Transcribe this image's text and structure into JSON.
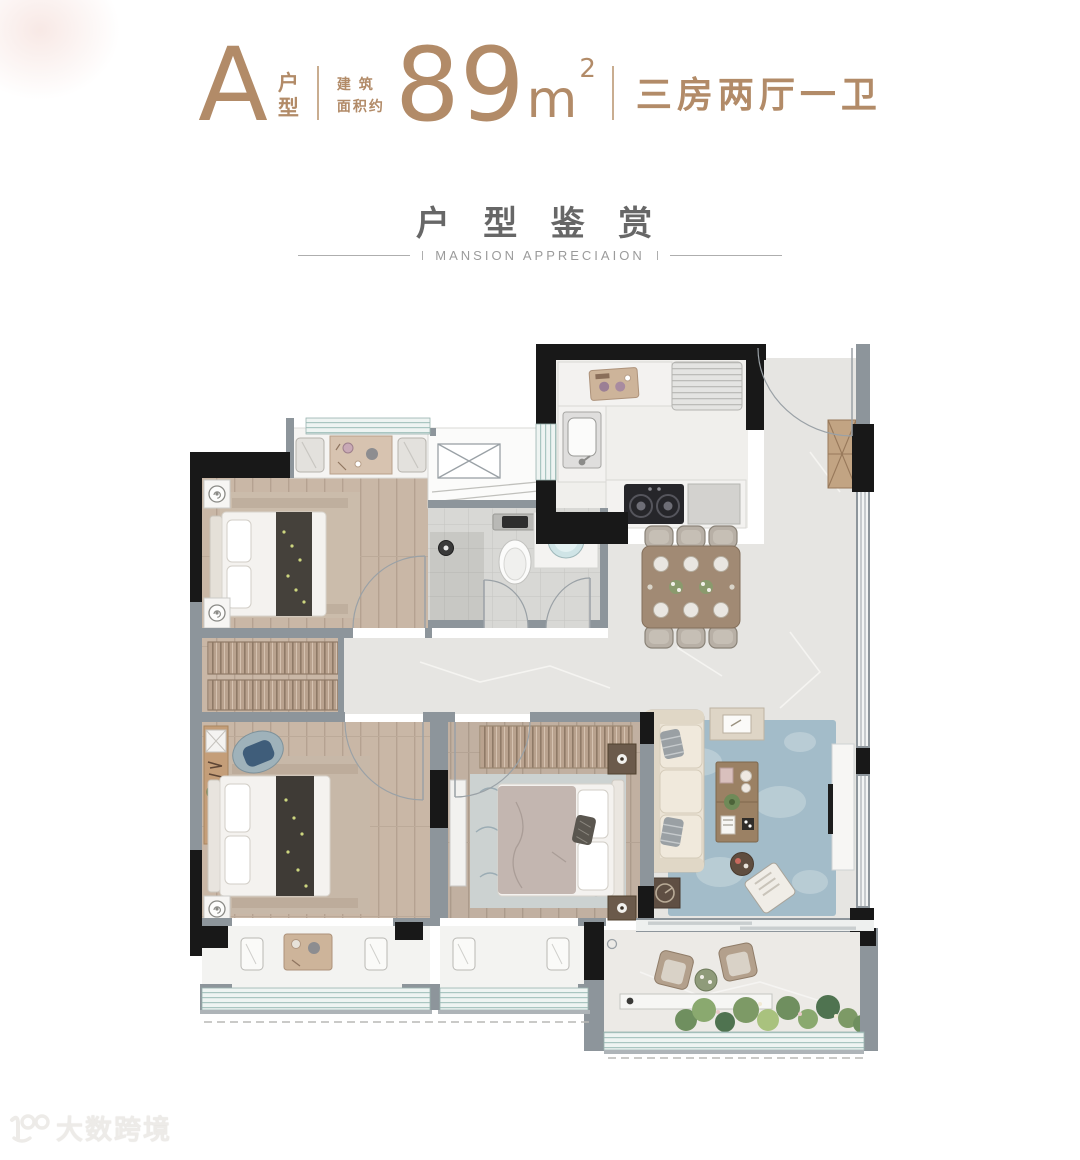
{
  "header": {
    "type_letter": "A",
    "type_label_1": "户",
    "type_label_2": "型",
    "area_prefix_line1": "建 筑",
    "area_prefix_line2": "面积约",
    "area_value": "89",
    "area_unit": "m",
    "area_sup": "2",
    "layout_desc": "三房两厅一卫"
  },
  "section": {
    "title": "户 型 鉴 赏",
    "subtitle": "MANSION APPRECIAION"
  },
  "watermark": {
    "text": "大数跨境"
  },
  "colors": {
    "accent_tan": "#b28b68",
    "title_gray": "#676767",
    "subtitle_gray": "#9b9b9b",
    "wall_gray": "#8d959b",
    "wall_black": "#181818",
    "wood_floor": "#c9b7a6",
    "wood_floor_alt": "#c1b0a1",
    "marble_floor": "#e6e5e2",
    "tile_floor": "#d8d8d5",
    "window_glass": "#eef4f2",
    "window_line": "#a9c6c1",
    "rug_blue": "#a3bcc9",
    "sofa_beige": "#eae2d4",
    "table_brown": "#a18a74",
    "wardrobe_tan": "#b9a28e",
    "bed_white": "#f4f2ef",
    "runner_dark": "#45413b",
    "accent_blue": "#46607d",
    "plant_green": "#7d9a66"
  }
}
